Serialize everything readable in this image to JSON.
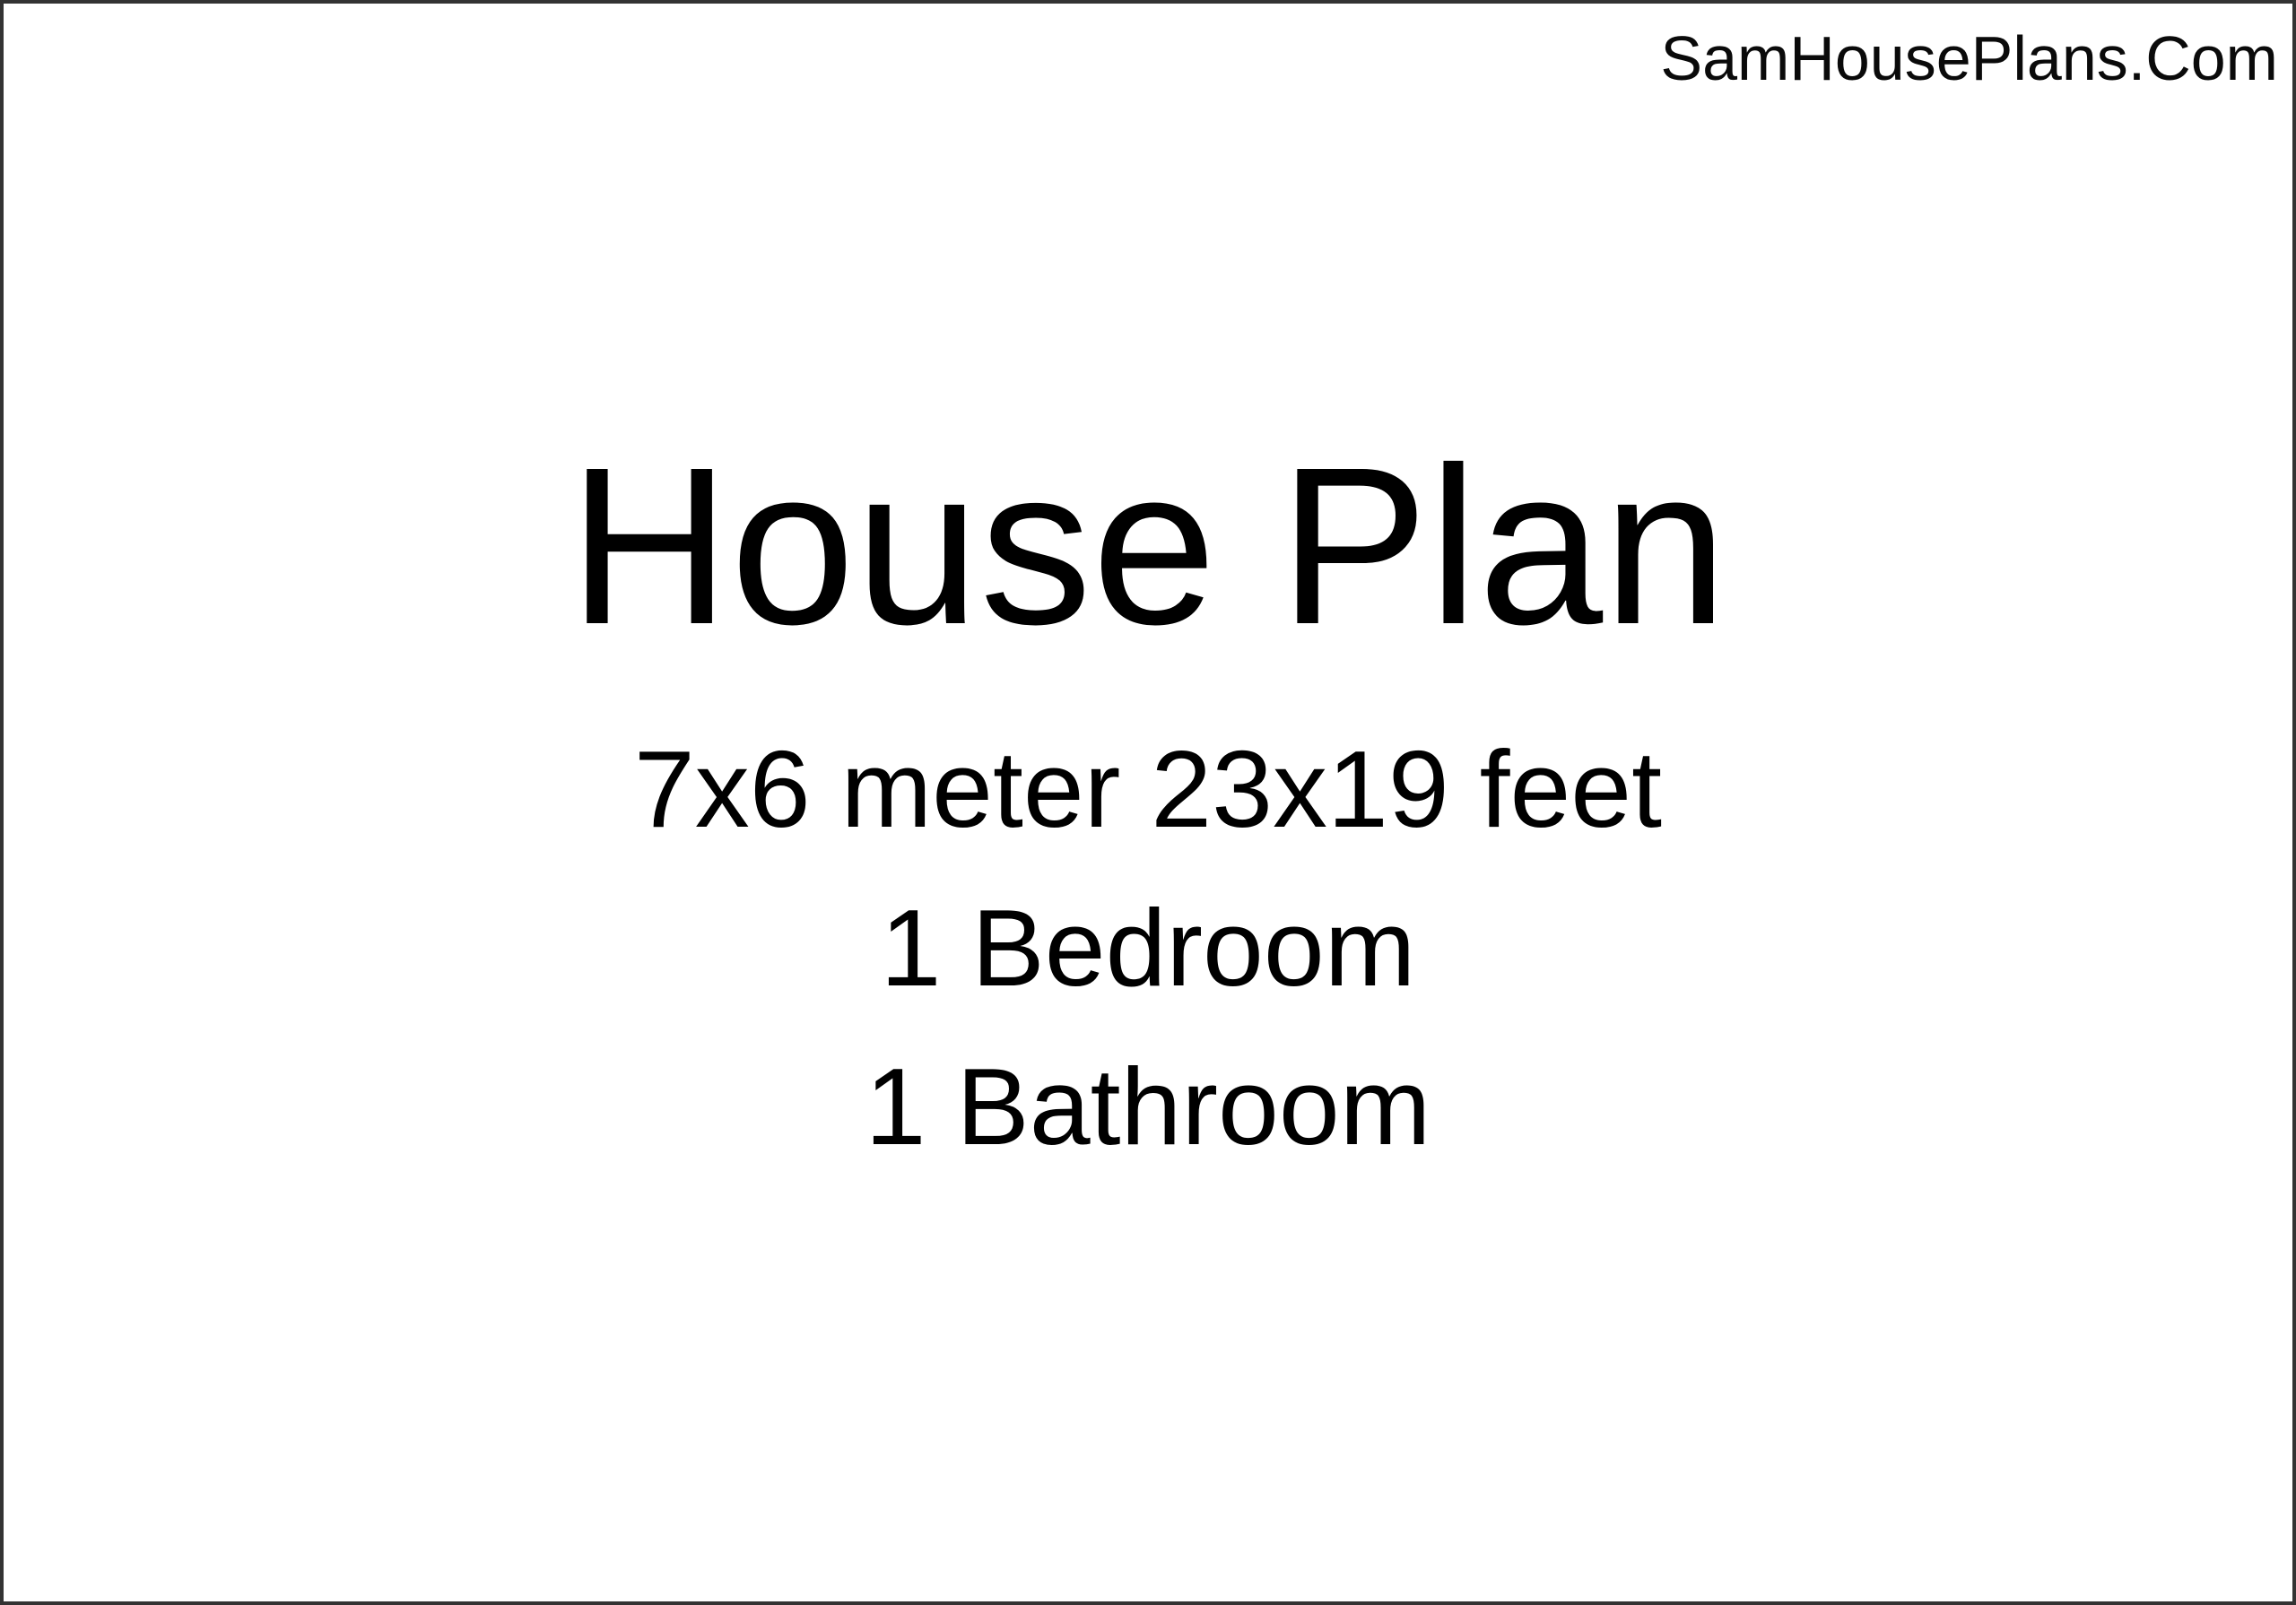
{
  "page": {
    "watermark": "SamHousePlans.Com",
    "title": "House Plan",
    "subtitle_lines": [
      "7x6 meter 23x19 feet",
      "1 Bedroom",
      "1 Bathroom"
    ],
    "colors": {
      "background": "#ffffff",
      "text": "#000000",
      "border": "#333333"
    }
  }
}
